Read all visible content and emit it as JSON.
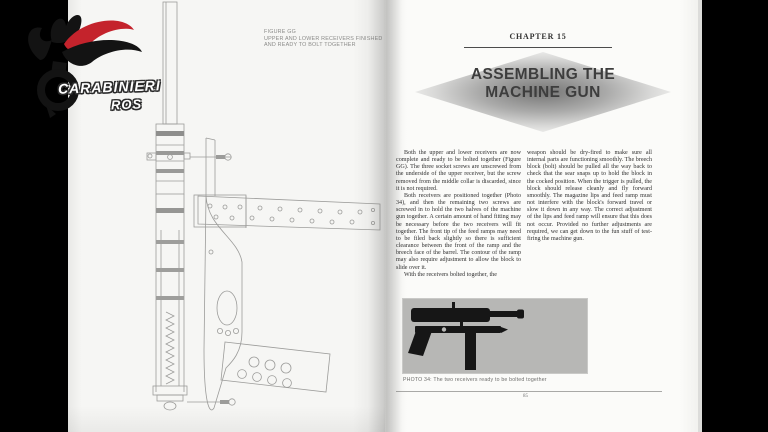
{
  "watermark": {
    "line1": "CARABINIERI",
    "line2": "ROS"
  },
  "left_page": {
    "figure_caption": [
      "FIGURE GG",
      "UPPER AND LOWER RECEIVERS FINISHED",
      "AND READY TO BOLT TOGETHER"
    ]
  },
  "right_page": {
    "chapter_heading": "CHAPTER 15",
    "title_lines": [
      "ASSEMBLING THE",
      "MACHINE GUN"
    ],
    "columns": [
      {
        "paragraphs": [
          "Both the upper and lower receivers are now complete and ready to be bolted together (Figure GG). The three socket screws are unscrewed from the underside of the upper receiver, but the screw removed from the middle collar is discarded, since it is not required.",
          "Both receivers are positioned together (Photo 34), and then the remaining two screws are screwed in to hold the two halves of the machine gun together. A certain amount of hand fitting may be necessary before the two receivers will fit together. The front tip of the feed ramps may need to be filed back slightly so there is sufficient clearance between the front of the ramp and the breech face of the barrel. The contour of the ramp may also require adjustment to allow the block to slide over it.",
          "With the receivers bolted together, the"
        ]
      },
      {
        "paragraphs": [
          "weapon should be dry-fired to make sure all internal parts are functioning smoothly. The breech block (bolt) should be pulled all the way back to check that the sear snaps up to hold the block in the cocked position. When the trigger is pulled, the block should release cleanly and fly forward smoothly. The magazine lips and feed ramp must not interfere with the block's forward travel or slow it down in any way. The correct adjustment of the lips and feed ramp will ensure that this does not occur. Provided no further adjustments are required, we can get down to the fun stuff of test-firing the machine gun."
        ]
      }
    ],
    "photo_caption": "PHOTO 34: The two receivers ready to be bolted together",
    "page_number": "85"
  },
  "colors": {
    "background": "#000000",
    "page": "#f6f6f4",
    "ribbon_red": "#c4232c",
    "diagram_line": "#9c9c9a",
    "photo_bg": "#b7b7b5",
    "silhouette": "#161616"
  }
}
